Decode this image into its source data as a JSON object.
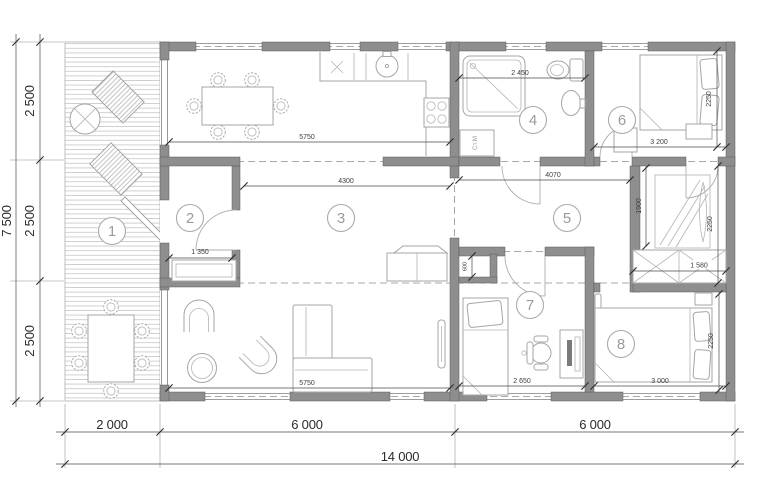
{
  "drawing_type": "floor-plan",
  "rooms": [
    {
      "number": "1"
    },
    {
      "number": "2"
    },
    {
      "number": "3"
    },
    {
      "number": "4"
    },
    {
      "number": "5"
    },
    {
      "number": "6"
    },
    {
      "number": "7"
    },
    {
      "number": "8"
    }
  ],
  "labels": {
    "washing_machine": "Ст.М"
  },
  "dims": {
    "exterior": {
      "left_total": "7 500",
      "left_segments": [
        "2 500",
        "2 500",
        "2 500"
      ],
      "bottom_segments": [
        "2 000",
        "6 000",
        "6 000"
      ],
      "bottom_total": "14 000"
    },
    "interior": {
      "dining_width": "5750",
      "living_top": "4300",
      "living_bottom": "5750",
      "entry": "1 350",
      "bath": "2 450",
      "bed6_w": "3 200",
      "bed6_d": "2250",
      "hall_w": "4070",
      "hall_d": "1900",
      "niche": "600",
      "wardrobe": "1 580",
      "closet_d": "2250",
      "room7_w": "2 650",
      "room8_w": "3 000",
      "bed8_d": "2250"
    }
  },
  "colors": {
    "wall": "#8e8e8e",
    "deck_line": "#c6c6c6",
    "furniture_line": "#a5a5a5",
    "dim_text": "#2b2b2b",
    "room_number": "#9b9b9b",
    "background": "#ffffff"
  }
}
